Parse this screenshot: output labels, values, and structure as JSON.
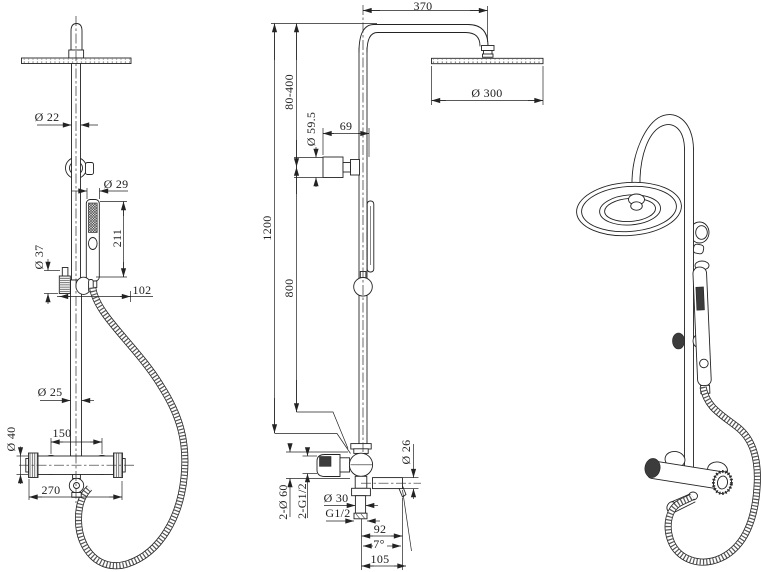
{
  "ink_color": "#232323",
  "background_color": "#ffffff",
  "dims": {
    "left": {
      "pipe_top": "Ø 22",
      "handset_head": "Ø 29",
      "handset_length": "211",
      "slider_ring": "Ø 37",
      "slider_offset": "102",
      "pipe_bottom": "Ø 25",
      "inlet_centers": "150",
      "valve_body": "Ø 40",
      "valve_width": "270"
    },
    "middle": {
      "arm_reach": "370",
      "height_range": "80-400",
      "flange": "Ø 59.5",
      "wall_offset": "69",
      "head": "Ø 300",
      "total_height": "1200",
      "lower_height": "800",
      "wall_unions": "2-Ø 60",
      "union_thread": "2-G1/2",
      "outlet": "Ø 30",
      "outlet_thread": "G1/2",
      "spout_reach": "92",
      "spout_angle": "7°",
      "spout_length": "105",
      "spout_pipe": "Ø 26"
    }
  }
}
